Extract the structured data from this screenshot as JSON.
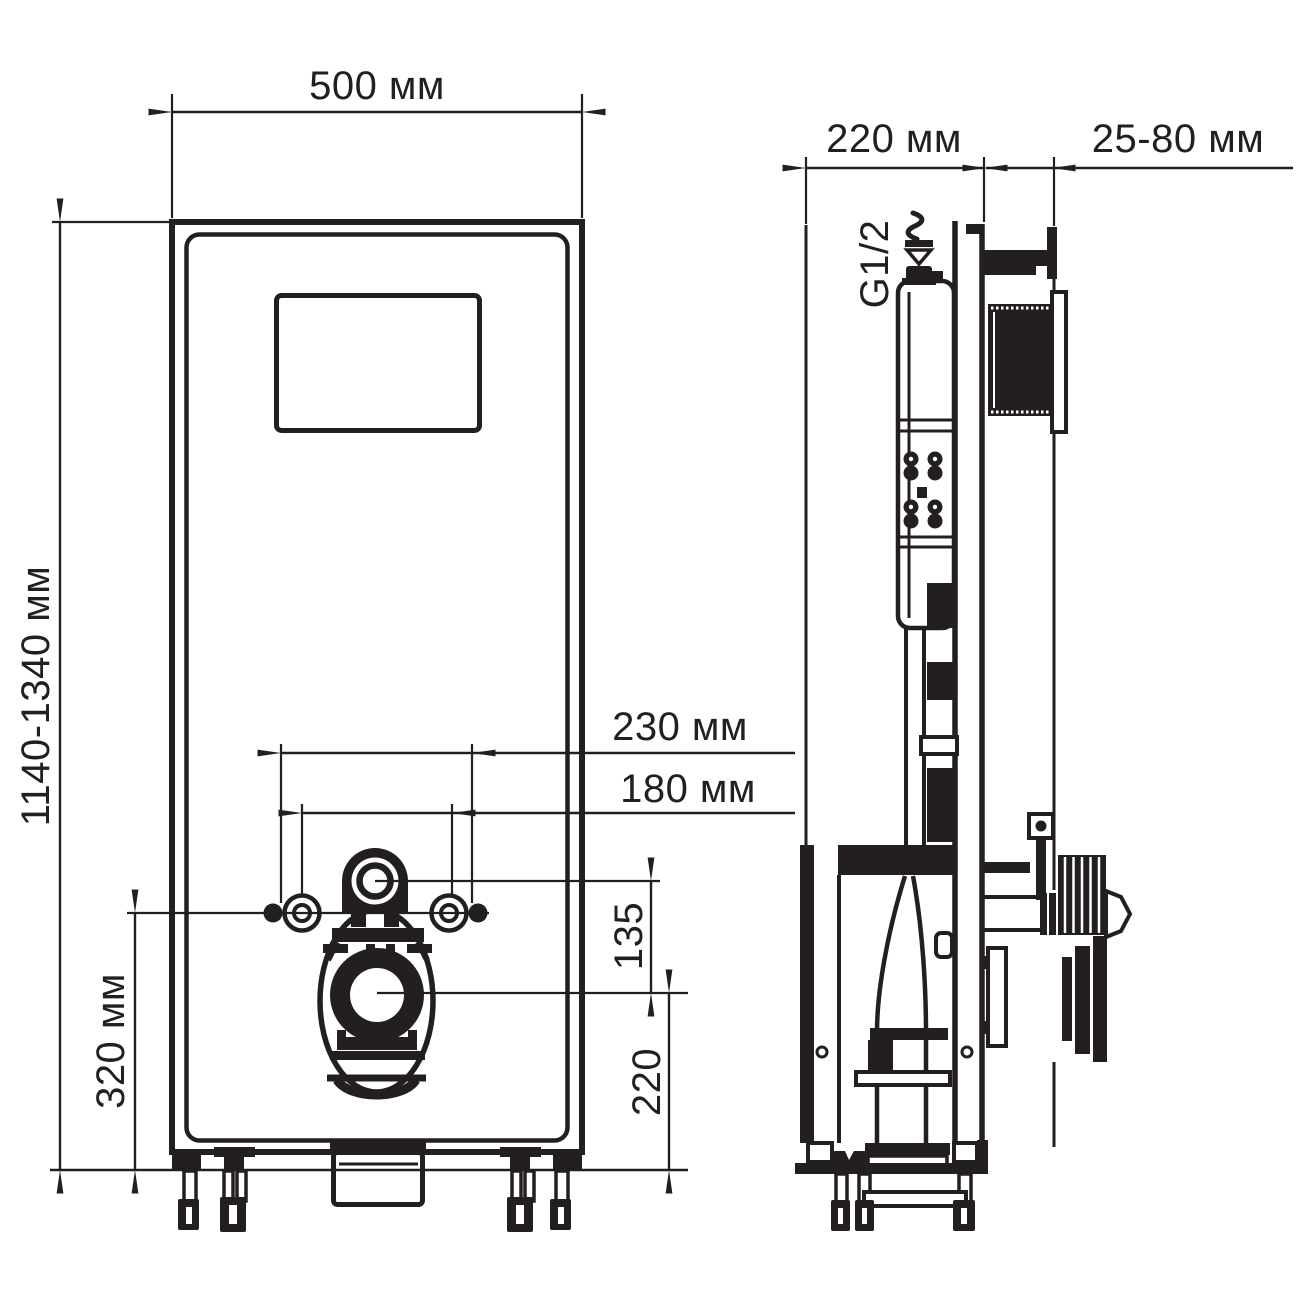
{
  "drawing": {
    "ink_color": "#231f20",
    "paper_color": "#ffffff",
    "front_view": {
      "width_label": "500 мм",
      "height_label": "1140-1340 мм",
      "anchor_span_outer_label": "230 мм",
      "anchor_span_inner_label": "180 мм",
      "inlet_drop_label": "135",
      "outlet_height_label": "220",
      "anchor_height_label": "320 мм"
    },
    "side_view": {
      "depth_label": "220 мм",
      "wall_offset_label": "25-80 мм",
      "water_inlet_label": "G1/2"
    }
  }
}
